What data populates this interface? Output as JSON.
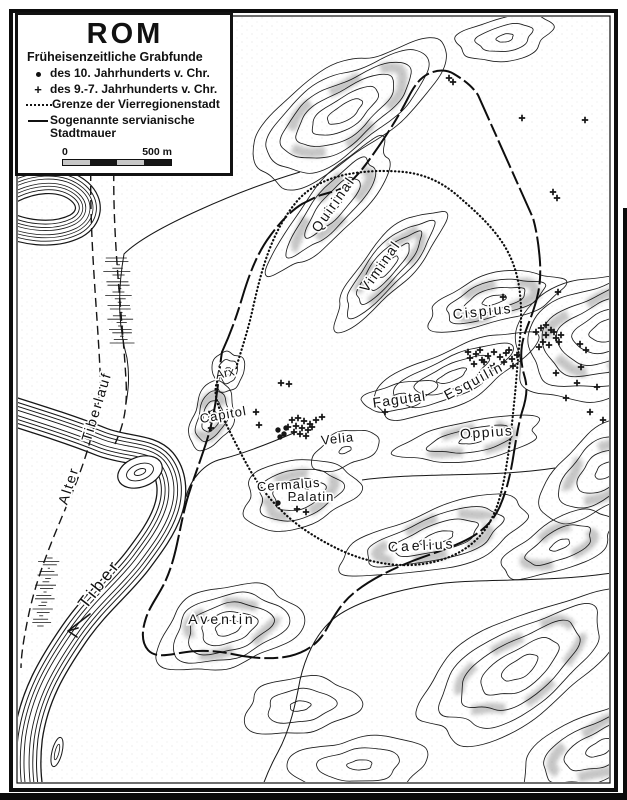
{
  "legend": {
    "title": "ROM",
    "heading": "Früheisenzeitliche Grabfunde",
    "items": [
      {
        "symbol": "dot-marker",
        "label": "des 10. Jahrhunderts v. Chr."
      },
      {
        "symbol": "cross-marker",
        "label": "des 9.-7. Jahrhunderts v. Chr."
      },
      {
        "symbol": "dotted-line",
        "label": "Grenze der Vierregionenstadt"
      },
      {
        "symbol": "solid-line",
        "label": "Sogenannte servianische Stadtmauer"
      }
    ],
    "scale": {
      "start": "0",
      "end": "500 m"
    }
  },
  "place_labels": [
    {
      "id": "quirinal",
      "text": "Quirinal",
      "x": 337,
      "y": 207,
      "rot": -55,
      "size": 14,
      "spacing": 2
    },
    {
      "id": "viminal",
      "text": "Viminal",
      "x": 384,
      "y": 269,
      "rot": -55,
      "size": 14,
      "spacing": 2
    },
    {
      "id": "cispius",
      "text": "Cispius",
      "x": 483,
      "y": 316,
      "rot": -6,
      "size": 14,
      "spacing": 2
    },
    {
      "id": "esquilin",
      "text": "Esquilin",
      "x": 476,
      "y": 385,
      "rot": -28,
      "size": 14,
      "spacing": 2
    },
    {
      "id": "fagutal",
      "text": "Fagutal",
      "x": 400,
      "y": 404,
      "rot": -8,
      "size": 14,
      "spacing": 1
    },
    {
      "id": "oppius",
      "text": "Oppius",
      "x": 487,
      "y": 437,
      "rot": -4,
      "size": 14,
      "spacing": 1.5
    },
    {
      "id": "velia",
      "text": "Velia",
      "x": 338,
      "y": 443,
      "rot": -6,
      "size": 13,
      "spacing": 1
    },
    {
      "id": "cermalus",
      "text": "Cermalus",
      "x": 289,
      "y": 489,
      "rot": -4,
      "size": 13,
      "spacing": 1
    },
    {
      "id": "palatin",
      "text": "Palatin",
      "x": 311,
      "y": 501,
      "rot": 0,
      "size": 13,
      "spacing": 1
    },
    {
      "id": "capitol",
      "text": "Capitol",
      "x": 224,
      "y": 419,
      "rot": -10,
      "size": 13,
      "spacing": 1
    },
    {
      "id": "arx",
      "text": "Arx",
      "x": 226,
      "y": 377,
      "rot": -12,
      "size": 12,
      "spacing": 0.5
    },
    {
      "id": "caelius",
      "text": "Caelius",
      "x": 422,
      "y": 550,
      "rot": -3,
      "size": 14,
      "spacing": 3
    },
    {
      "id": "aventin",
      "text": "Aventin",
      "x": 222,
      "y": 624,
      "rot": 0,
      "size": 14,
      "spacing": 3
    },
    {
      "id": "tiber",
      "text": "Tiber",
      "x": 104,
      "y": 587,
      "rot": -52,
      "size": 17,
      "spacing": 4
    },
    {
      "id": "alter",
      "text": "Alter",
      "x": 73,
      "y": 487,
      "rot": -72,
      "size": 14,
      "spacing": 2
    },
    {
      "id": "tiberlauf",
      "text": "Tiberlauf",
      "x": 101,
      "y": 408,
      "rot": -73,
      "size": 14,
      "spacing": 2
    }
  ],
  "grave_finds": {
    "dots_10th_century": [
      [
        278,
        430
      ],
      [
        284,
        434
      ],
      [
        280,
        437
      ],
      [
        286,
        428
      ],
      [
        278,
        503
      ]
    ],
    "crosses_9_7_century": [
      [
        292,
        420
      ],
      [
        298,
        418
      ],
      [
        304,
        421
      ],
      [
        310,
        424
      ],
      [
        296,
        426
      ],
      [
        302,
        428
      ],
      [
        308,
        430
      ],
      [
        294,
        432
      ],
      [
        300,
        434
      ],
      [
        306,
        436
      ],
      [
        312,
        427
      ],
      [
        288,
        427
      ],
      [
        316,
        420
      ],
      [
        322,
        417
      ],
      [
        385,
        412
      ],
      [
        297,
        509
      ],
      [
        306,
        512
      ],
      [
        209,
        414
      ],
      [
        211,
        428
      ],
      [
        256,
        412
      ],
      [
        259,
        425
      ],
      [
        281,
        383
      ],
      [
        289,
        384
      ],
      [
        449,
        78
      ],
      [
        453,
        82
      ],
      [
        522,
        118
      ],
      [
        585,
        120
      ],
      [
        553,
        192
      ],
      [
        557,
        198
      ],
      [
        503,
        297
      ],
      [
        558,
        292
      ],
      [
        470,
        358
      ],
      [
        476,
        354
      ],
      [
        482,
        360
      ],
      [
        488,
        356
      ],
      [
        494,
        352
      ],
      [
        500,
        357
      ],
      [
        506,
        353
      ],
      [
        512,
        359
      ],
      [
        517,
        355
      ],
      [
        474,
        364
      ],
      [
        484,
        362
      ],
      [
        494,
        366
      ],
      [
        504,
        362
      ],
      [
        513,
        366
      ],
      [
        468,
        352
      ],
      [
        480,
        350
      ],
      [
        490,
        368
      ],
      [
        509,
        350
      ],
      [
        536,
        332
      ],
      [
        541,
        328
      ],
      [
        546,
        335
      ],
      [
        551,
        330
      ],
      [
        556,
        338
      ],
      [
        543,
        342
      ],
      [
        549,
        345
      ],
      [
        554,
        332
      ],
      [
        559,
        342
      ],
      [
        539,
        347
      ],
      [
        561,
        335
      ],
      [
        546,
        325
      ],
      [
        580,
        344
      ],
      [
        586,
        350
      ],
      [
        581,
        367
      ],
      [
        597,
        387
      ],
      [
        577,
        383
      ],
      [
        556,
        373
      ],
      [
        566,
        398
      ],
      [
        590,
        412
      ],
      [
        612,
        372
      ],
      [
        603,
        420
      ]
    ]
  },
  "colors": {
    "ink": "#161616",
    "paper": "#ffffff",
    "slope_shade": "#8d8d8d"
  }
}
